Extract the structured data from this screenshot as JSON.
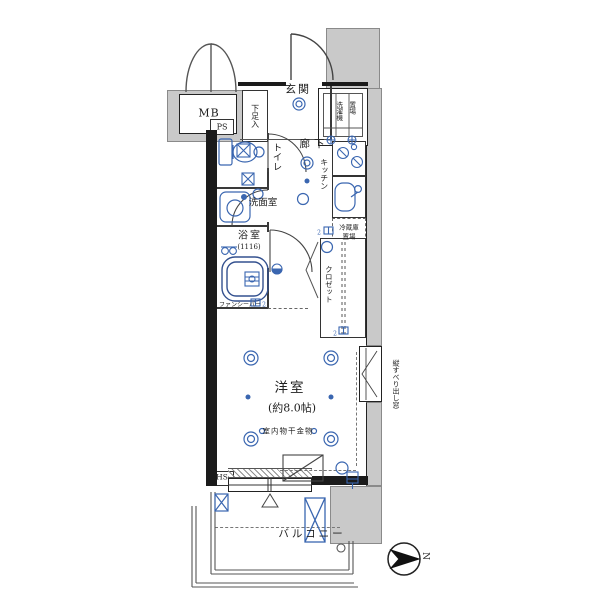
{
  "floorplan": {
    "title_hint": "Japanese one-room apartment floor plan",
    "labels": {
      "mb": "MB",
      "ps": "PS",
      "hs": "HS",
      "entrance": "玄関",
      "shoe_cabinet": "下足入",
      "toilet": "トイレ",
      "hallway": "廊下",
      "kitchen": "キッチン",
      "washer_col1": "洗濯機",
      "washer_col2": "置場",
      "washroom": "洗面室",
      "bathroom": "浴室",
      "bathroom_size": "(1116)",
      "fridge_line1": "冷蔵庫",
      "fridge_line2": "置場",
      "closet": "クロゼット",
      "fan_bar": "ファンシーバー",
      "main_room": "洋室",
      "main_room_size": "(約8.0帖)",
      "laundry_fitting": "室内物干金物",
      "balcony": "バルコニー",
      "casement_window": "縦すべり出し窓",
      "north": "N",
      "outlet_sub": "2"
    },
    "colors": {
      "exterior_gray": "#c9c9c9",
      "wall_black": "#1b1b1b",
      "symbol_blue": "#3a66b0",
      "line": "#3c3c3c"
    }
  }
}
